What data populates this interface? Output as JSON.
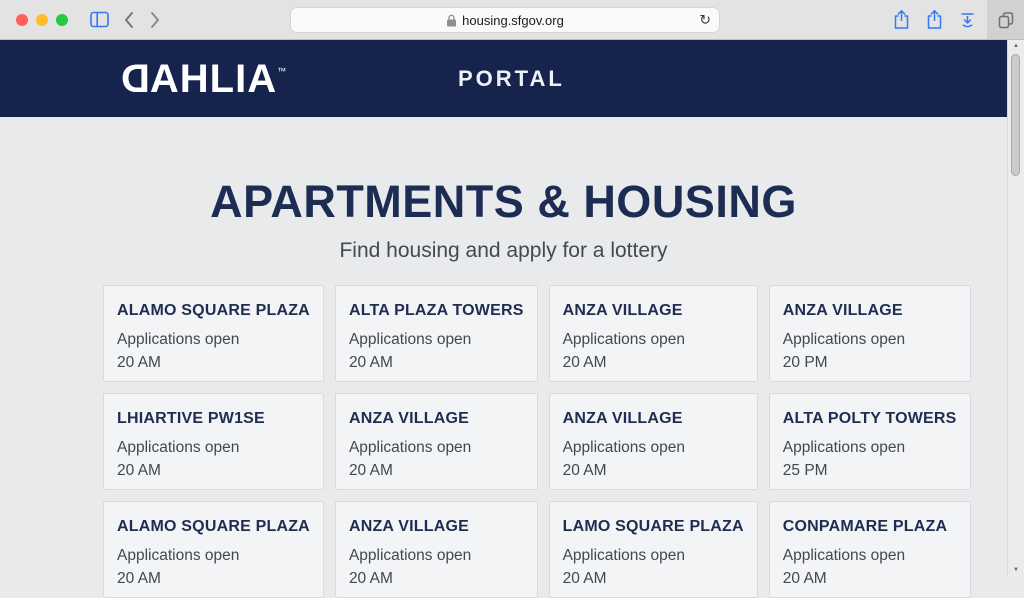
{
  "browser": {
    "url": "housing.sfgov.org",
    "reload_glyph": "↻",
    "scroll_up_glyph": "▲",
    "scroll_down_glyph": "▼"
  },
  "header": {
    "brand_d": "D",
    "brand_rest": "AHLIA",
    "brand_tm": "™",
    "nav_label": "PORTAL"
  },
  "page": {
    "title": "APARTMENTS & HOUSING",
    "subtitle": "Find housing and apply for a lottery"
  },
  "listings": [
    {
      "name": "ALAMO SQUARE PLAZA",
      "status": "Applications open",
      "time": "20 AM"
    },
    {
      "name": "ALTA PLAZA TOWERS",
      "status": "Applications open",
      "time": "20 AM"
    },
    {
      "name": "ANZA VILLAGE",
      "status": "Applications open",
      "time": "20 AM"
    },
    {
      "name": "ANZA VILLAGE",
      "status": "Applications open",
      "time": "20 PM"
    },
    {
      "name": "LHIARTIVE PW1SE",
      "status": "Applications open",
      "time": "20 AM"
    },
    {
      "name": "ANZA VILLAGE",
      "status": "Applications open",
      "time": "20 AM"
    },
    {
      "name": "ANZA VILLAGE",
      "status": "Applications open",
      "time": "20 AM"
    },
    {
      "name": "ALTA POLTY TOWERS",
      "status": "Applications open",
      "time": "25 PM"
    },
    {
      "name": "ALAMO SQUARE PLAZA",
      "status": "Applications open",
      "time": "20 AM"
    },
    {
      "name": "ANZA VILLAGE",
      "status": "Applications open",
      "time": "20 AM"
    },
    {
      "name": "LAMO SQUARE PLAZA",
      "status": "Applications open",
      "time": "20 AM"
    },
    {
      "name": "CONPAMARE PLAZA",
      "status": "Applications open",
      "time": "20 AM"
    }
  ],
  "colors": {
    "accent_blue": "#3478f6",
    "header_navy": "#16244d",
    "title_navy": "#1d2c52",
    "page_bg": "#e8eaec",
    "card_bg": "#f3f4f6",
    "traffic_red": "#ff5f57",
    "traffic_yellow": "#febc2e",
    "traffic_green": "#28c840"
  }
}
